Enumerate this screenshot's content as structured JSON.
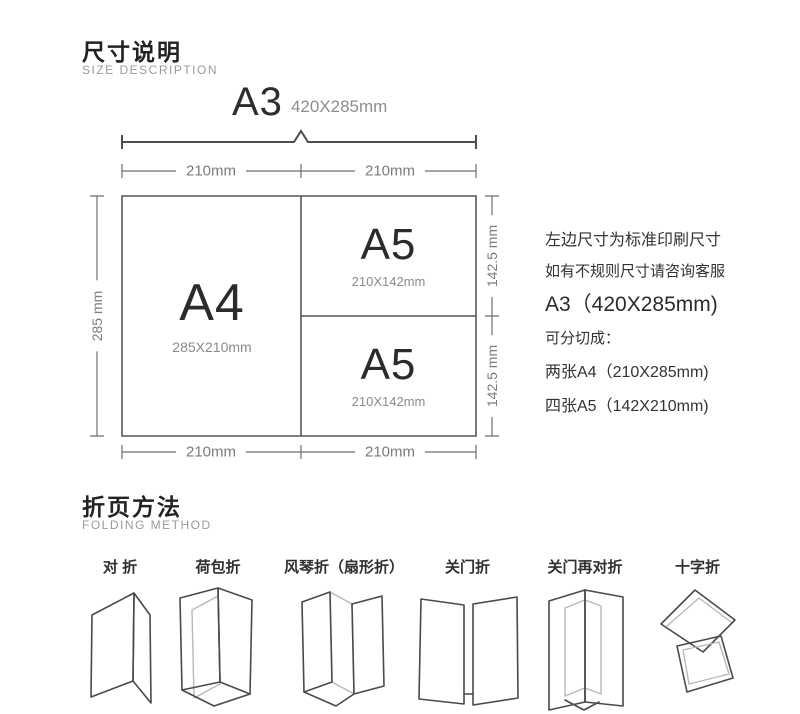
{
  "size_section": {
    "title": "尺寸说明",
    "subtitle": "SIZE DESCRIPTION",
    "a3_label": "A3",
    "a3_dims": "420X285mm",
    "top_dim_left": "210mm",
    "top_dim_right": "210mm",
    "bottom_dim_left": "210mm",
    "bottom_dim_right": "210mm",
    "left_dim": "285 mm",
    "right_dim_top": "142.5 mm",
    "right_dim_bottom": "142.5 mm",
    "cells": {
      "a4": {
        "label": "A4",
        "dims": "285X210mm"
      },
      "a5_top": {
        "label": "A5",
        "dims": "210X142mm"
      },
      "a5_bottom": {
        "label": "A5",
        "dims": "210X142mm"
      }
    },
    "notes": [
      "左边尺寸为标准印刷尺寸",
      "如有不规则尺寸请咨询客服",
      "A3（420X285mm)",
      "可分切成：",
      "两张A4（210X285mm)",
      "四张A5（142X210mm)"
    ]
  },
  "folding_section": {
    "title": "折页方法",
    "subtitle": "FOLDING METHOD",
    "methods": [
      {
        "label": "对 折",
        "icon": "half-fold-icon"
      },
      {
        "label": "荷包折",
        "icon": "pocket-fold-icon"
      },
      {
        "label": "风琴折（扇形折）",
        "icon": "accordion-fold-icon"
      },
      {
        "label": "关门折",
        "icon": "gate-fold-icon"
      },
      {
        "label": "关门再对折",
        "icon": "gate-half-fold-icon"
      },
      {
        "label": "十字折",
        "icon": "cross-fold-icon"
      }
    ]
  },
  "colors": {
    "background": "#ffffff",
    "diagram_line": "#565656",
    "text_primary": "#333333",
    "text_muted": "#9a9a9a",
    "dim_text": "#7b7b7b"
  }
}
